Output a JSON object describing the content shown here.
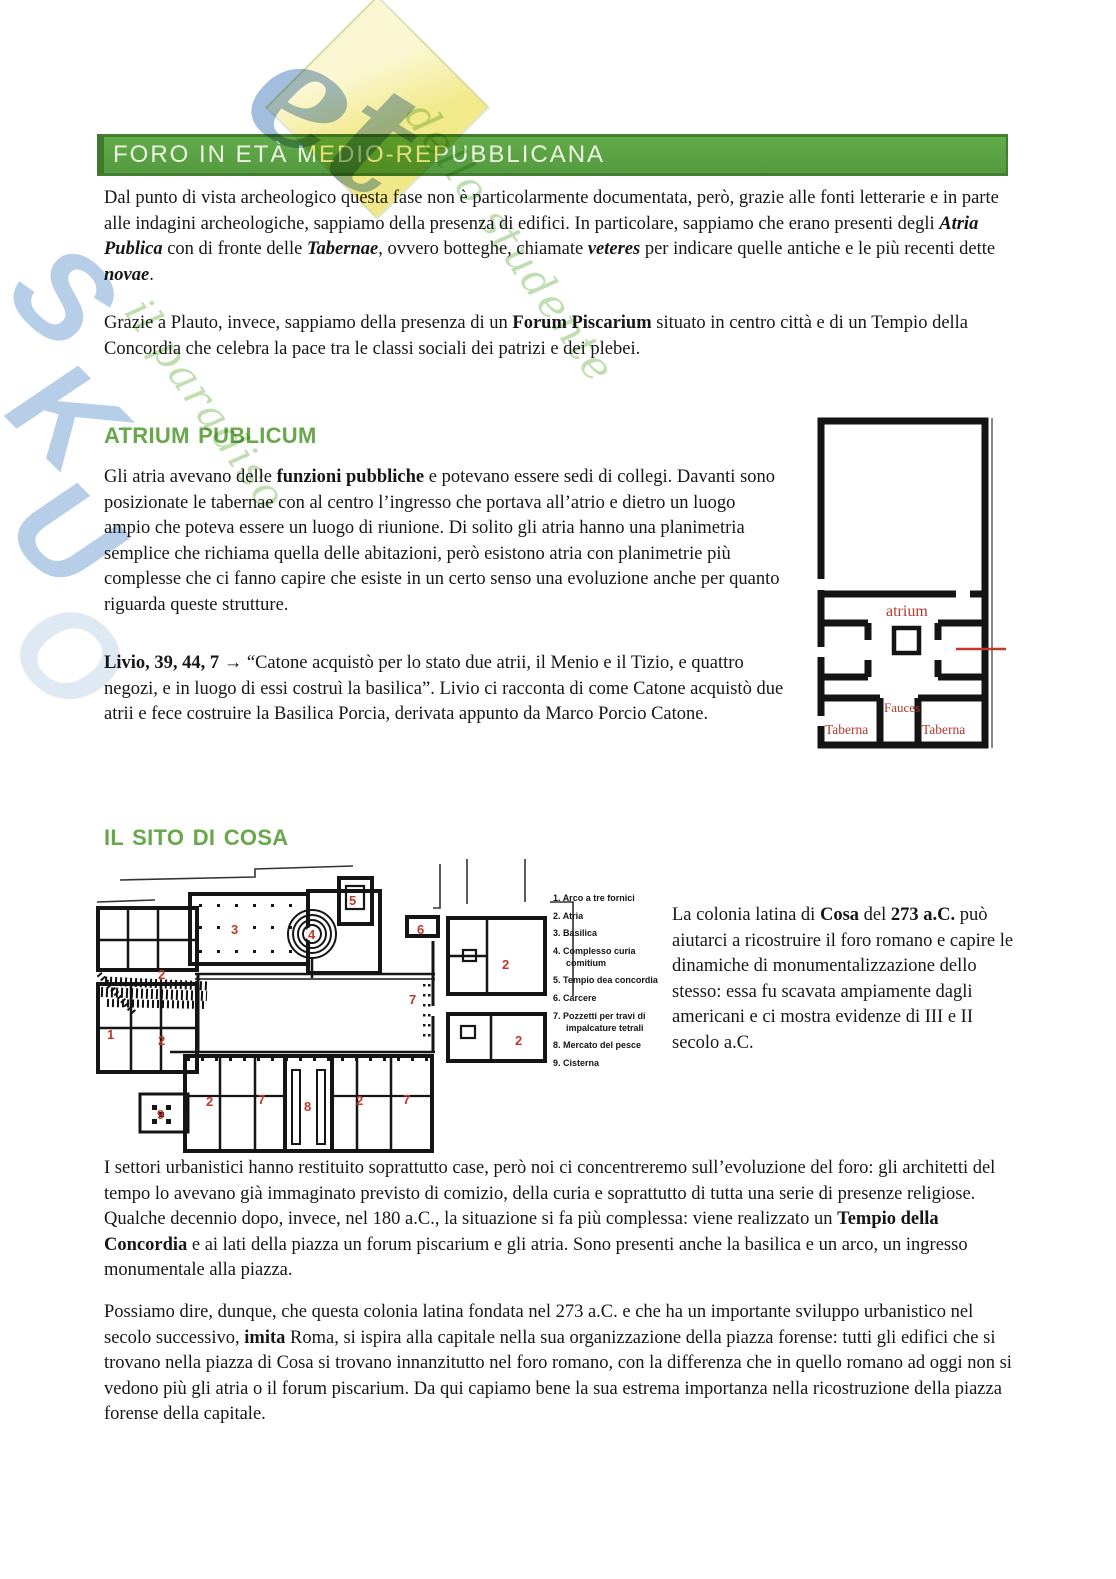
{
  "colors": {
    "accent_green": "#68a74b",
    "bar_green": "#5aa343",
    "plan_red": "#c0392b"
  },
  "watermark": {
    "letters": [
      "S",
      "K",
      "U",
      "O"
    ],
    "net": "et",
    "script1": "il paradiso",
    "script2": "dello studente"
  },
  "header": {
    "title": "FORO IN ETÀ MEDIO-REPUBBLICANA"
  },
  "intro": {
    "p1": [
      {
        "t": "Dal punto di vista archeologico questa fase non è particolarmente documentata, però, grazie alle fonti letterarie e in parte alle indagini archeologiche, sappiamo della presenza di edifici. In particolare, sappiamo che erano presenti degli "
      },
      {
        "t": "Atria Publica",
        "b": true,
        "i": true
      },
      {
        "t": " con di fronte delle "
      },
      {
        "t": "Tabernae",
        "b": true,
        "i": true
      },
      {
        "t": ", ovvero botteghe, chiamate "
      },
      {
        "t": "veteres",
        "b": true,
        "i": true
      },
      {
        "t": " per indicare quelle antiche e le più recenti dette "
      },
      {
        "t": "novae",
        "b": true,
        "i": true
      },
      {
        "t": "."
      }
    ],
    "p2": [
      {
        "t": "Grazie a Plauto, invece, sappiamo della presenza di un "
      },
      {
        "t": "Forum Piscarium",
        "b": true
      },
      {
        "t": " situato in centro città e di un Tempio della Concordia che celebra la pace tra le classi sociali dei patrizi e dei plebei."
      }
    ]
  },
  "atrium": {
    "heading": "ATRIUM PUBLICUM",
    "p1": [
      {
        "t": "Gli atria avevano delle "
      },
      {
        "t": "funzioni pubbliche",
        "b": true
      },
      {
        "t": " e potevano essere sedi di collegi. Davanti sono posizionate le tabernae con al centro l’ingresso che portava all’atrio e dietro un luogo ampio che poteva essere un luogo di riunione. Di solito gli atria hanno una planimetria semplice che richiama quella delle abitazioni, però esistono atria con planimetrie più complesse che ci fanno capire che esiste in un certo senso una evoluzione anche per quanto riguarda queste strutture."
      }
    ],
    "p2": [
      {
        "t": "Livio, 39, 44, 7 →",
        "b": true
      },
      {
        "t": " “Catone acquistò per lo stato due atrii, il Menio e il Tizio, e quattro negozi, e in luogo di essi costruì la basilica”.  Livio ci racconta di come Catone acquistò due atrii e fece costruire la Basilica Porcia, derivata appunto da Marco Porcio Catone."
      }
    ],
    "figure": {
      "room": "atrium",
      "fauces": "Fauces",
      "taberna_left": "Taberna",
      "taberna_right": "Taberna"
    }
  },
  "cosa": {
    "heading": "IL SITO DI COSA",
    "legend": [
      {
        "num": "1.",
        "label": "Arco a tre fornici"
      },
      {
        "num": "2.",
        "label": "Atria"
      },
      {
        "num": "3.",
        "label": "Basilica"
      },
      {
        "num": "4.",
        "label": "Complesso curia comitium"
      },
      {
        "num": "5.",
        "label": "Tempio dea concordia"
      },
      {
        "num": "6.",
        "label": "Carcere"
      },
      {
        "num": "7.",
        "label": "Pozzetti per travi di impalcature tetrali"
      },
      {
        "num": "8.",
        "label": "Mercato del pesce"
      },
      {
        "num": "9.",
        "label": "Cisterna"
      }
    ],
    "markers": [
      "1",
      "2",
      "2",
      "3",
      "4",
      "5",
      "6",
      "7",
      "2",
      "2",
      "2",
      "7",
      "8",
      "2",
      "7",
      "9"
    ],
    "side": [
      {
        "t": "La colonia latina di "
      },
      {
        "t": "Cosa",
        "b": true
      },
      {
        "t": " del "
      },
      {
        "t": "273 a.C.",
        "b": true
      },
      {
        "t": " può aiutarci a ricostruire il foro romano e capire le dinamiche di monumentalizzazione dello stesso: essa fu scavata ampiamente dagli americani e ci mostra evidenze di III e II secolo a.C."
      }
    ]
  },
  "closing": {
    "p1": [
      {
        "t": "I settori urbanistici hanno restituito soprattutto case, però noi ci concentreremo sull’evoluzione del foro: gli architetti del tempo lo avevano già immaginato previsto di comizio, della curia e soprattutto di tutta una serie di presenze religiose. Qualche decennio dopo, invece, nel 180 a.C., la situazione si fa più complessa: viene realizzato un "
      },
      {
        "t": "Tempio della Concordia",
        "b": true
      },
      {
        "t": " e ai lati della piazza un forum piscarium e gli atria. Sono presenti anche la basilica e un arco, un ingresso monumentale alla piazza."
      }
    ],
    "p2": [
      {
        "t": "Possiamo dire, dunque, che questa colonia latina fondata nel 273 a.C. e che ha un importante sviluppo urbanistico nel secolo successivo, "
      },
      {
        "t": "imita",
        "b": true
      },
      {
        "t": " Roma, si ispira alla capitale nella sua organizzazione della piazza forense: tutti gli edifici che si trovano nella piazza di Cosa si trovano innanzitutto nel foro romano, con la differenza che in quello romano ad oggi non si vedono più gli atria o il forum piscarium. Da qui capiamo bene la sua estrema importanza nella ricostruzione della piazza forense della capitale."
      }
    ]
  }
}
